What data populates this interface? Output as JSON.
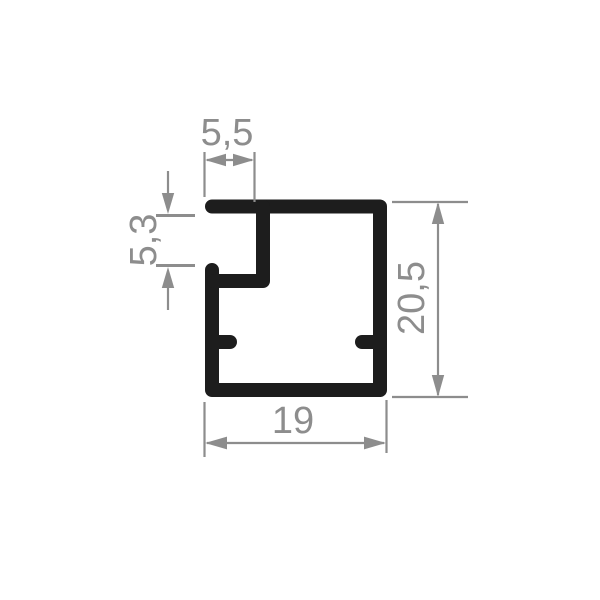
{
  "page": {
    "background": "#ffffff"
  },
  "drawing": {
    "kind": "profile-cross-section",
    "colors": {
      "profile": "#1d1d1d",
      "dimension": "#8d8d8d"
    },
    "dimensions": {
      "slot_width": {
        "label": "5,5",
        "value": 5.5,
        "orientation": "horizontal",
        "position": "top"
      },
      "slot_depth": {
        "label": "5,3",
        "value": 5.3,
        "orientation": "vertical",
        "position": "left"
      },
      "overall_height": {
        "label": "20,5",
        "value": 20.5,
        "orientation": "vertical",
        "position": "right"
      },
      "overall_width": {
        "label": "19",
        "value": 19,
        "orientation": "horizontal",
        "position": "bottom"
      }
    }
  }
}
